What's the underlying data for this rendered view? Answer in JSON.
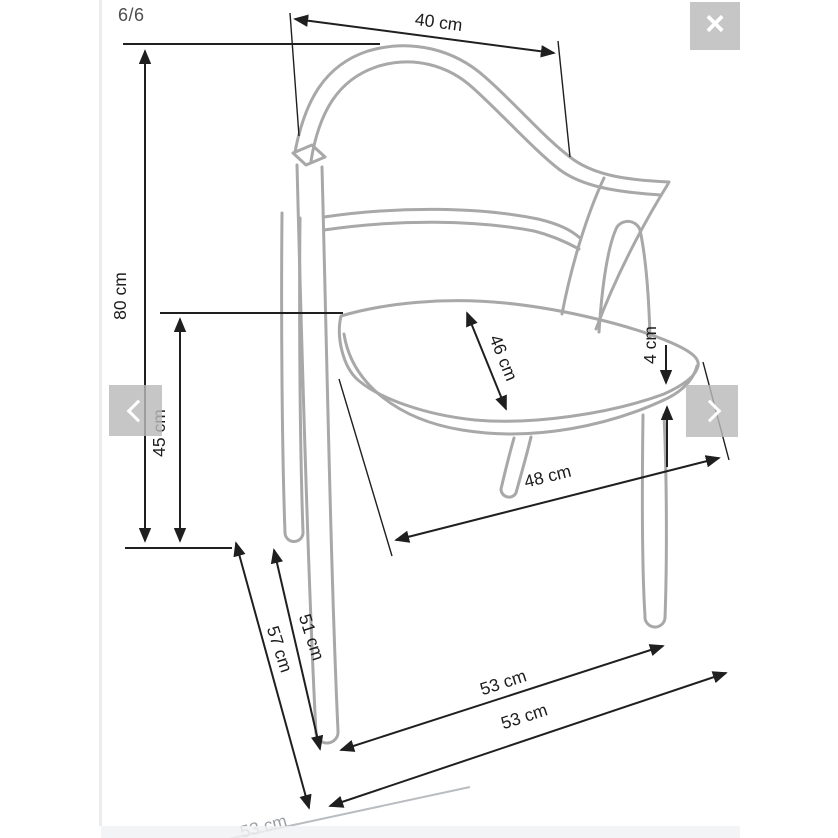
{
  "lightbox": {
    "counter": "6/6",
    "controls": {
      "close": {
        "icon": "x-mark",
        "glyph": "×"
      },
      "prev": {
        "icon": "chevron-left"
      },
      "next": {
        "icon": "chevron-right"
      }
    }
  },
  "diagram": {
    "unit": "cm",
    "dimensions": [
      {
        "name": "backrest-width",
        "label": "40 cm"
      },
      {
        "name": "total-height",
        "label": "80 cm"
      },
      {
        "name": "seat-height",
        "label": "45 cm"
      },
      {
        "name": "seat-depth",
        "label": "46 cm"
      },
      {
        "name": "seat-thickness",
        "label": "4 cm"
      },
      {
        "name": "seat-width",
        "label": "48 cm"
      },
      {
        "name": "base-depth",
        "label": "57 cm"
      },
      {
        "name": "front-leg-length",
        "label": "51 cm"
      },
      {
        "name": "base-width-rear",
        "label": "53 cm"
      },
      {
        "name": "base-width-front",
        "label": "53 cm"
      },
      {
        "name": "base-width-partial",
        "label": "53 cm"
      }
    ]
  },
  "colors": {
    "dimension_line": "#1f1f1f",
    "chair_line": "#a8a8a8",
    "control_background": "#c4c4c4",
    "control_glyph": "#ffffff",
    "bottom_strip": "#eff1f3",
    "counter_text": "#4f4f4f",
    "divider": "#ececec"
  }
}
